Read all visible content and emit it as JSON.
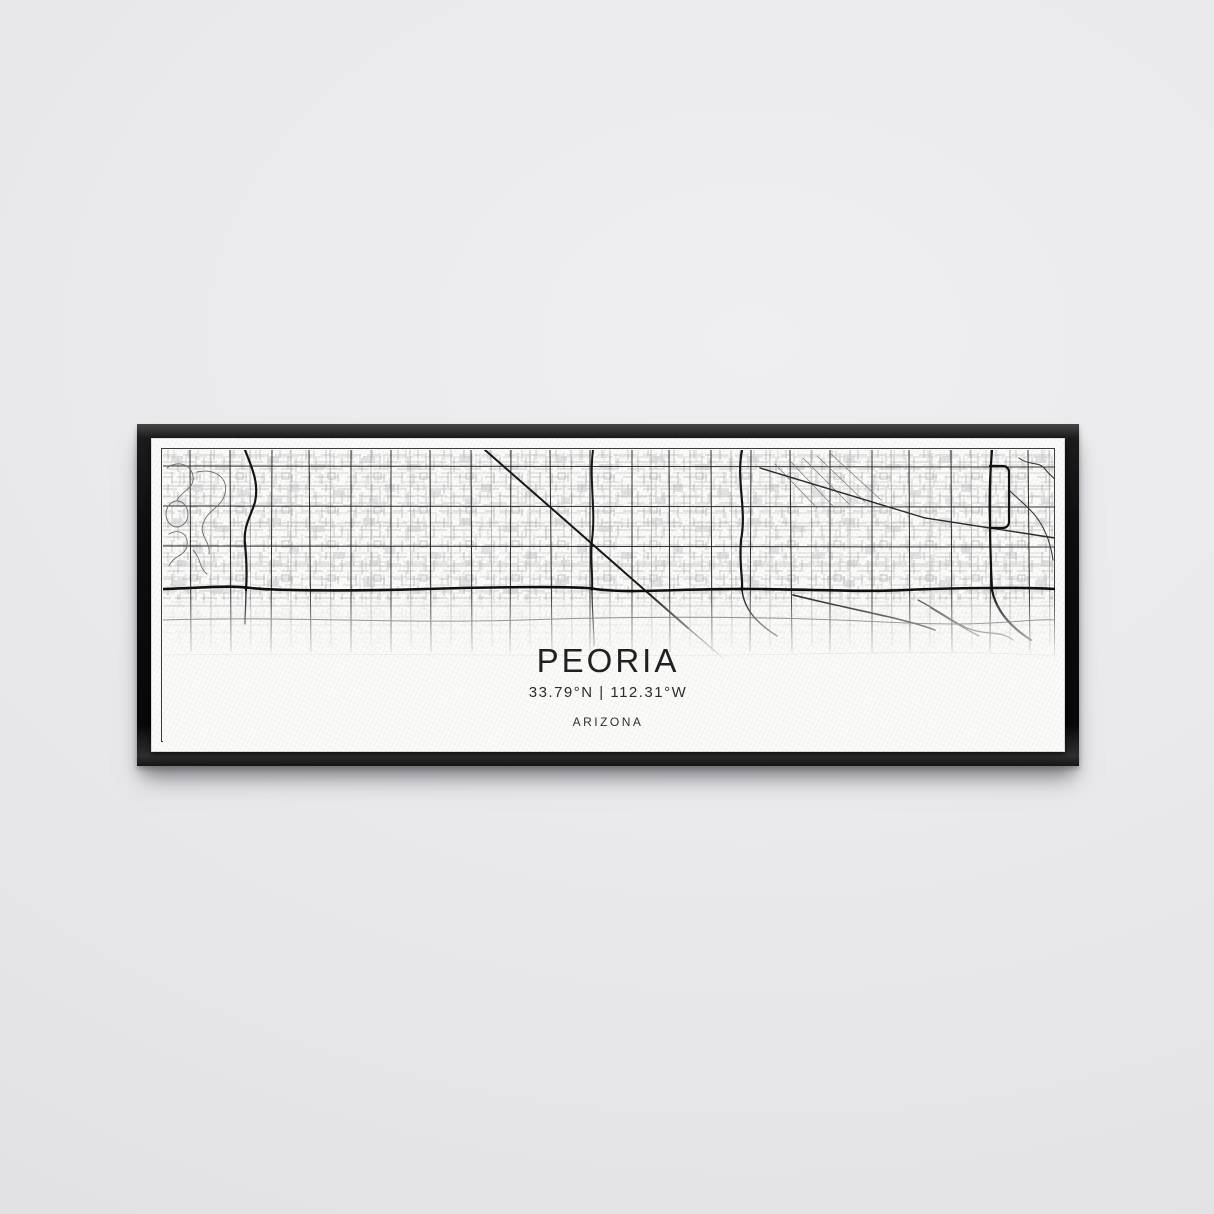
{
  "poster": {
    "city": "PEORIA",
    "coordinates": "33.79°N | 112.31°W",
    "region": "ARIZONA"
  },
  "scene": {
    "wall_color": "#e9e9eb",
    "frame_color": "#0e0e0e",
    "canvas_color": "#fbfbfa",
    "map_major_line_color": "#1d1d1d",
    "map_minor_line_color": "#8f8f8f"
  }
}
